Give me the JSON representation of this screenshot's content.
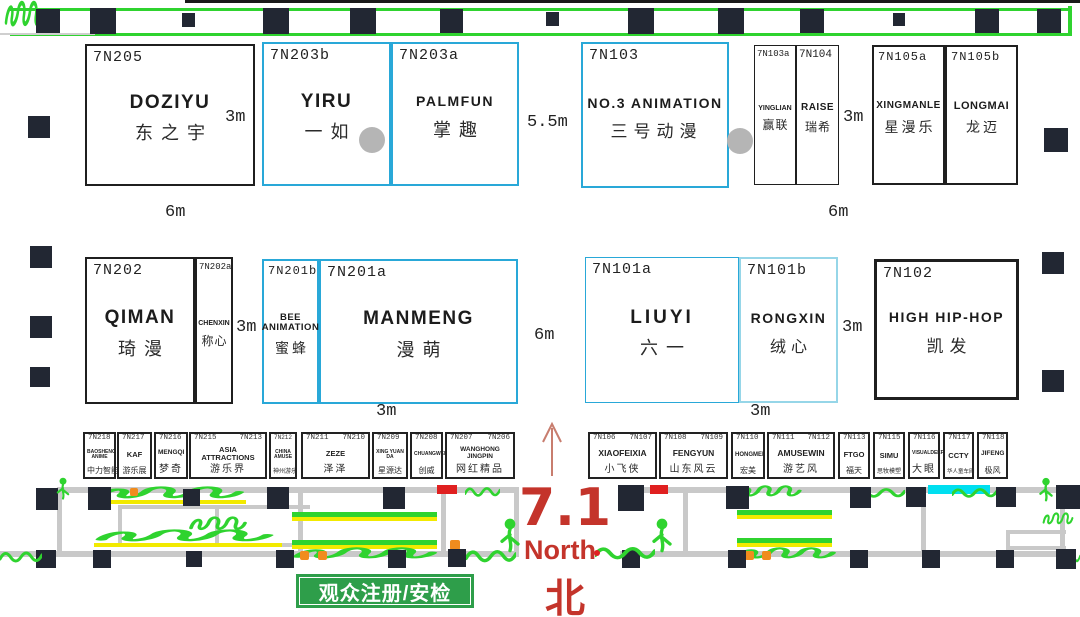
{
  "hall_marker": {
    "hall": "7.1",
    "north_en": "North",
    "north_zh": "北"
  },
  "registration": {
    "label": "观众注册/安检"
  },
  "measurements": {
    "m1": "3m",
    "m2": "5.5m",
    "m3": "3m",
    "m4": "6m",
    "m5": "6m",
    "m6": "3m",
    "m7": "6m",
    "m8": "3m",
    "m9": "3m",
    "m10": "3m"
  },
  "booths": [
    {
      "id": "7N205",
      "en": "DOZIYU",
      "zh": "东之宇"
    },
    {
      "id": "7N203b",
      "en": "YIRU",
      "zh": "一如"
    },
    {
      "id": "7N203a",
      "en": "PALMFUN",
      "zh": "掌趣"
    },
    {
      "id": "7N103",
      "en": "NO.3 ANIMATION",
      "zh": "三号动漫"
    },
    {
      "id": "7N103a",
      "en": "YINGLIAN",
      "zh": "赢联"
    },
    {
      "id": "7N104",
      "en": "RAISE",
      "zh": "瑞希"
    },
    {
      "id": "7N105a",
      "en": "XINGMANLE",
      "zh": "星漫乐"
    },
    {
      "id": "7N105b",
      "en": "LONGMAI",
      "zh": "龙迈"
    },
    {
      "id": "7N202",
      "en": "QIMAN",
      "zh": "琦漫"
    },
    {
      "id": "7N202a",
      "en": "CHENXIN",
      "zh": "称心"
    },
    {
      "id": "7N201b",
      "en": "BEE ANIMATION",
      "zh": "蜜蜂"
    },
    {
      "id": "7N201a",
      "en": "MANMENG",
      "zh": "漫萌"
    },
    {
      "id": "7N101a",
      "en": "LIUYI",
      "zh": "六一"
    },
    {
      "id": "7N101b",
      "en": "RONGXIN",
      "zh": "绒心"
    },
    {
      "id": "7N102",
      "en": "HIGH HIP-HOP",
      "zh": "凯发"
    }
  ],
  "strip_left": [
    {
      "n1": "7N218",
      "n2": "",
      "en": "BAOSHENG ANIME",
      "zh": "中力智能"
    },
    {
      "n1": "7N217",
      "n2": "",
      "en": "KAF",
      "zh": "游乐展"
    },
    {
      "n1": "7N216",
      "n2": "",
      "en": "MENGQI",
      "zh": "梦奇"
    },
    {
      "n1": "7N215",
      "n2": "7N213",
      "en": "ASIA ATTRACTIONS",
      "zh": "游乐界"
    },
    {
      "n1": "7N212",
      "n2": "",
      "en": "CHINA AMUSE",
      "zh": "神州游乐"
    },
    {
      "n1": "7N211",
      "n2": "7N210",
      "en": "ZEZE",
      "zh": "泽泽"
    },
    {
      "n1": "7N209",
      "n2": "",
      "en": "XING YUAN DA",
      "zh": "星源达"
    },
    {
      "n1": "7N208",
      "n2": "",
      "en": "CHUANGWEI",
      "zh": "创威"
    },
    {
      "n1": "7N207",
      "n2": "7N206",
      "en": "WANGHONG JINGPIN",
      "zh": "网红精品"
    }
  ],
  "strip_right": [
    {
      "n1": "7N106",
      "n2": "7N107",
      "en": "XIAOFEIXIA",
      "zh": "小飞侠"
    },
    {
      "n1": "7N108",
      "n2": "7N109",
      "en": "FENGYUN",
      "zh": "山东风云"
    },
    {
      "n1": "7N110",
      "n2": "",
      "en": "HONGMEI",
      "zh": "宏美"
    },
    {
      "n1": "7N111",
      "n2": "7N112",
      "en": "AMUSEWIN",
      "zh": "游艺风"
    },
    {
      "n1": "7N113",
      "n2": "",
      "en": "FTGO",
      "zh": "福天"
    },
    {
      "n1": "7N115",
      "n2": "",
      "en": "SIMU",
      "zh": "思牧模塑"
    },
    {
      "n1": "7N116",
      "n2": "",
      "en": "VISUALDEEP",
      "zh": "大眼"
    },
    {
      "n1": "7N117",
      "n2": "",
      "en": "CCTY",
      "zh": "华人童车网"
    },
    {
      "n1": "7N118",
      "n2": "",
      "en": "JIFENG",
      "zh": "极风"
    }
  ],
  "colors": {
    "green_line": "#2fd32f",
    "registration_green": "#2e9e4a",
    "red_text": "#c4342b",
    "arrow_red": "#c87d6e",
    "blue_border": "#29a8d8",
    "light_blue_border": "#96d6e8",
    "black_border": "#1f1f1f",
    "pillar": "#222733",
    "wall_gray": "#c9c9c9",
    "circle_gray": "#b5b5b5",
    "yellow": "#f2ea00",
    "orange": "#f08c1e",
    "cyan": "#00dff0"
  }
}
